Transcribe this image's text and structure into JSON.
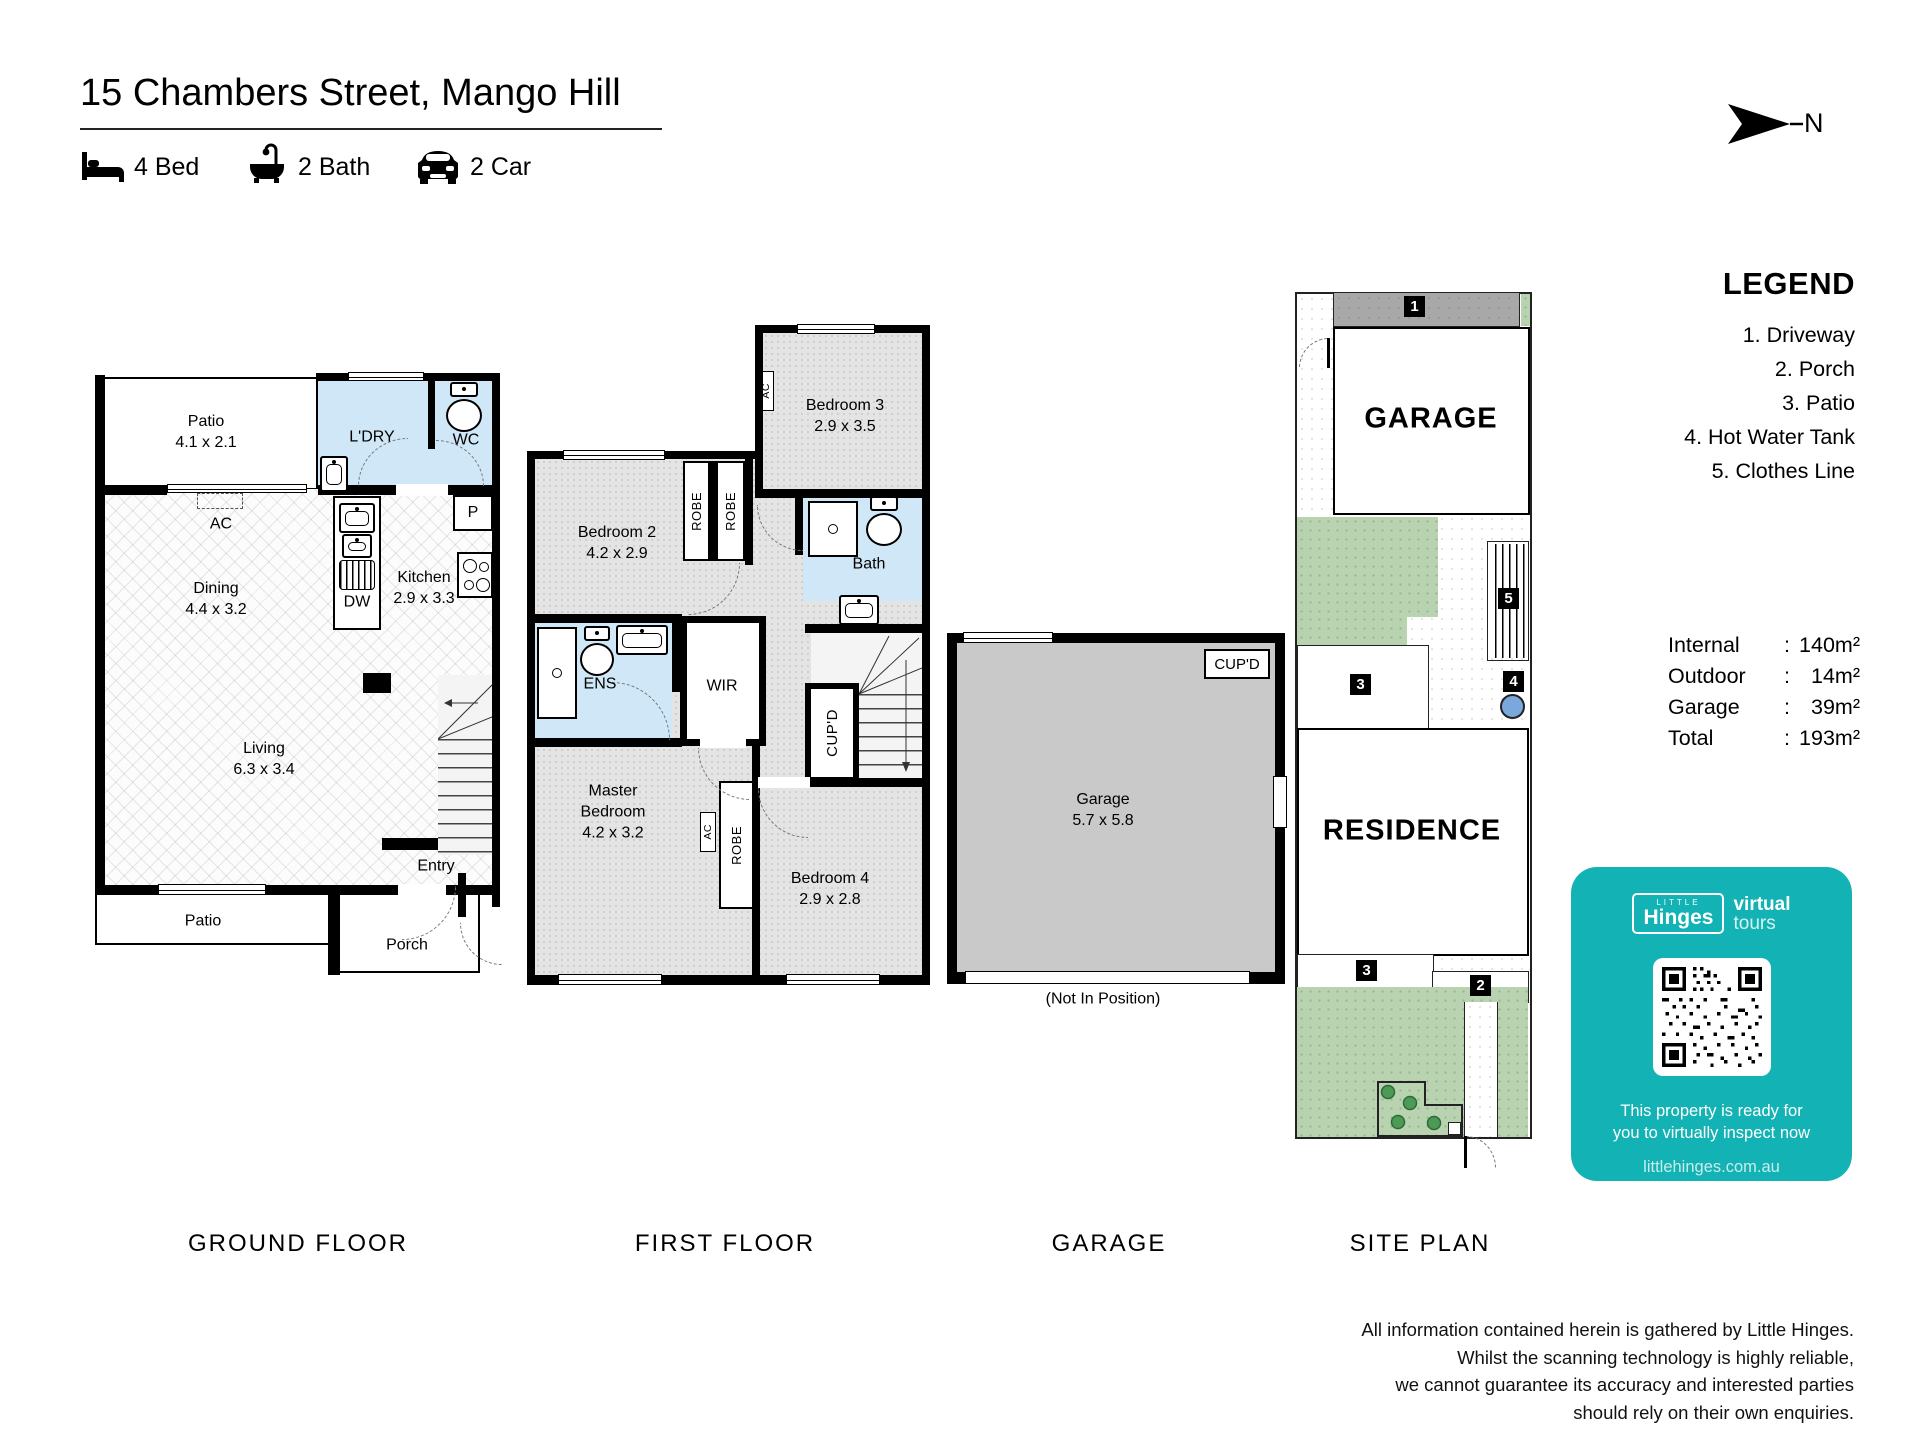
{
  "colors": {
    "teal": "#13b2b4",
    "wet_area": "#cfe7f6",
    "carpet": "#e3e3e3",
    "garage_fill": "#c9c9c9",
    "lawn": "#b9d3b0",
    "driveway": "#a8a8a8",
    "hot_water_tank": "#7aa7dc"
  },
  "header": {
    "title": "15 Chambers Street, Mango Hill",
    "beds": "4 Bed",
    "baths": "2 Bath",
    "cars": "2 Car",
    "north": "N"
  },
  "gf": {
    "caption": "GROUND FLOOR",
    "patio_top": {
      "name": "Patio",
      "dims": "4.1 x 2.1"
    },
    "ldry": "L'DRY",
    "wc": "WC",
    "ac": "AC",
    "pantry": "P",
    "dw": "DW",
    "dining": {
      "name": "Dining",
      "dims": "4.4 x 3.2"
    },
    "kitchen": {
      "name": "Kitchen",
      "dims": "2.9 x 3.3"
    },
    "living": {
      "name": "Living",
      "dims": "6.3 x 3.4"
    },
    "entry": "Entry",
    "patio_bottom": "Patio",
    "porch": "Porch"
  },
  "ff": {
    "caption": "FIRST FLOOR",
    "bedroom2": {
      "name": "Bedroom 2",
      "dims": "4.2 x 2.9"
    },
    "bedroom3": {
      "name": "Bedroom 3",
      "dims": "2.9 x 3.5"
    },
    "bedroom4": {
      "name": "Bedroom 4",
      "dims": "2.9 x 2.8"
    },
    "master": {
      "l1": "Master",
      "l2": "Bedroom",
      "dims": "4.2 x 3.2"
    },
    "bath": "Bath",
    "ens": "ENS",
    "wir": "WIR",
    "cupd": "CUP'D",
    "robe": "ROBE",
    "ac": "AC"
  },
  "gp": {
    "caption": "GARAGE",
    "room": {
      "name": "Garage",
      "dims": "5.7 x 5.8"
    },
    "cupd": "CUP'D",
    "note": "(Not In Position)"
  },
  "sp": {
    "caption": "SITE PLAN",
    "garage": "GARAGE",
    "residence": "RESIDENCE",
    "m1": "1",
    "m2": "2",
    "m3": "3",
    "m4": "4",
    "m5": "5"
  },
  "legend": {
    "title": "LEGEND",
    "items": [
      "1. Driveway",
      "2. Porch",
      "3. Patio",
      "4. Hot Water Tank",
      "5. Clothes Line"
    ]
  },
  "areas": {
    "colon": ":",
    "rows": [
      {
        "label": "Internal",
        "value": "140m²"
      },
      {
        "label": "Outdoor",
        "value": "14m²"
      },
      {
        "label": "Garage",
        "value": "39m²"
      },
      {
        "label": "Total",
        "value": "193m²"
      }
    ]
  },
  "badge": {
    "brand_top": "LITTLE",
    "brand_name": "Hinges",
    "brand_virtual": "virtual",
    "brand_tours": "tours",
    "message_l1": "This property is ready for",
    "message_l2": "you to virtually inspect now",
    "website": "littlehinges.com.au"
  },
  "footer": {
    "l1": "All information contained herein is gathered by Little Hinges.",
    "l2": "Whilst the scanning technology is highly reliable,",
    "l3": "we cannot guarantee its accuracy and interested parties",
    "l4": "should rely on their own enquiries."
  }
}
